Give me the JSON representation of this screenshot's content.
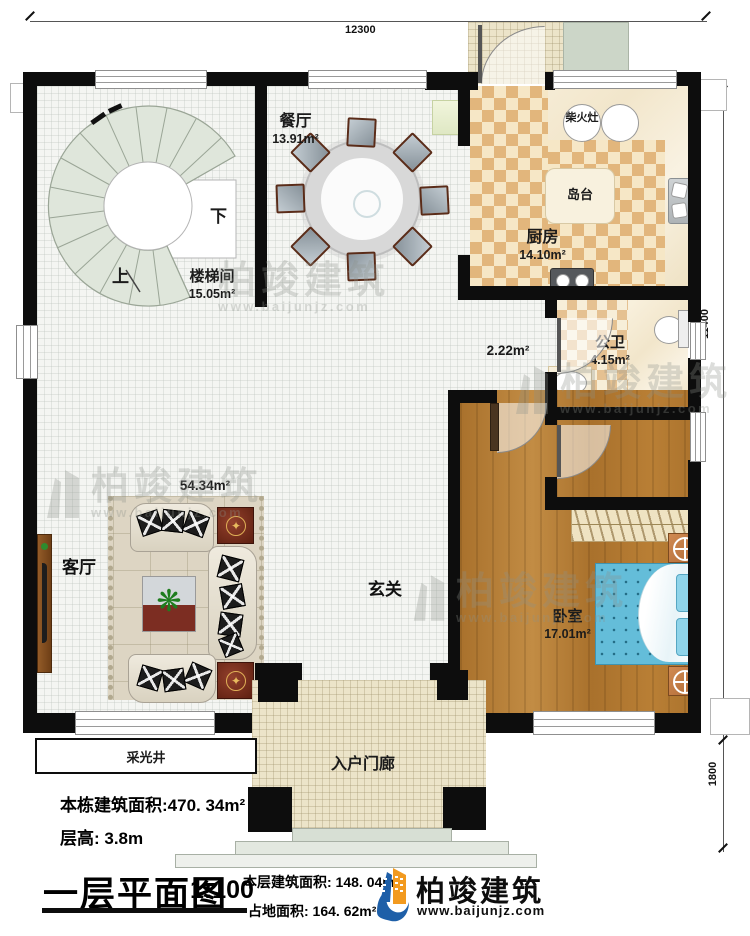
{
  "dimensions": {
    "top": "12300",
    "right_upper": "11400",
    "right_lower": "1800"
  },
  "rooms": {
    "stairwell": {
      "name": "楼梯间",
      "area": "15.05m²"
    },
    "stairs_up": "上",
    "stairs_down": "下",
    "dining": {
      "name": "餐厅",
      "area": "13.91m²"
    },
    "kitchen": {
      "name": "厨房",
      "area": "14.10m²",
      "island": "岛台",
      "wood_stove": "柴火灶"
    },
    "public_bath": {
      "name": "公卫",
      "area": "4.15m²"
    },
    "inner_bath": {
      "name": "内卫",
      "area": "4.15m²"
    },
    "corridor": {
      "area": "2.22m²"
    },
    "living": {
      "name": "客厅",
      "area": "54.34m²"
    },
    "foyer": {
      "name": "玄关"
    },
    "bedroom": {
      "name": "卧室",
      "area": "17.01m²"
    },
    "light_well": {
      "name": "采光井"
    },
    "entry_porch": {
      "name": "入户门廊"
    }
  },
  "info": {
    "total_area": "本栋建筑面积:470. 34m²",
    "floor_height": "层高: 3.8m"
  },
  "title_block": {
    "title": "一层平面图",
    "scale": "1:100",
    "floor_area": "本层建筑面积: 148. 04m²",
    "land_area": "占地面积: 164. 62m²"
  },
  "brand": {
    "name": "柏竣建筑",
    "site": "www.baijunjz.com"
  },
  "watermark": {
    "name": "柏竣建筑",
    "site": "www.baijunjz.com"
  },
  "colors": {
    "accent_blue": "#1e5fa8",
    "accent_orange": "#f29a1f",
    "wall": "#0d0d0d",
    "wood_floor": "#b0762f",
    "kitchen_tile": "#e2b67c",
    "bed_blue": "#64bdd9"
  }
}
